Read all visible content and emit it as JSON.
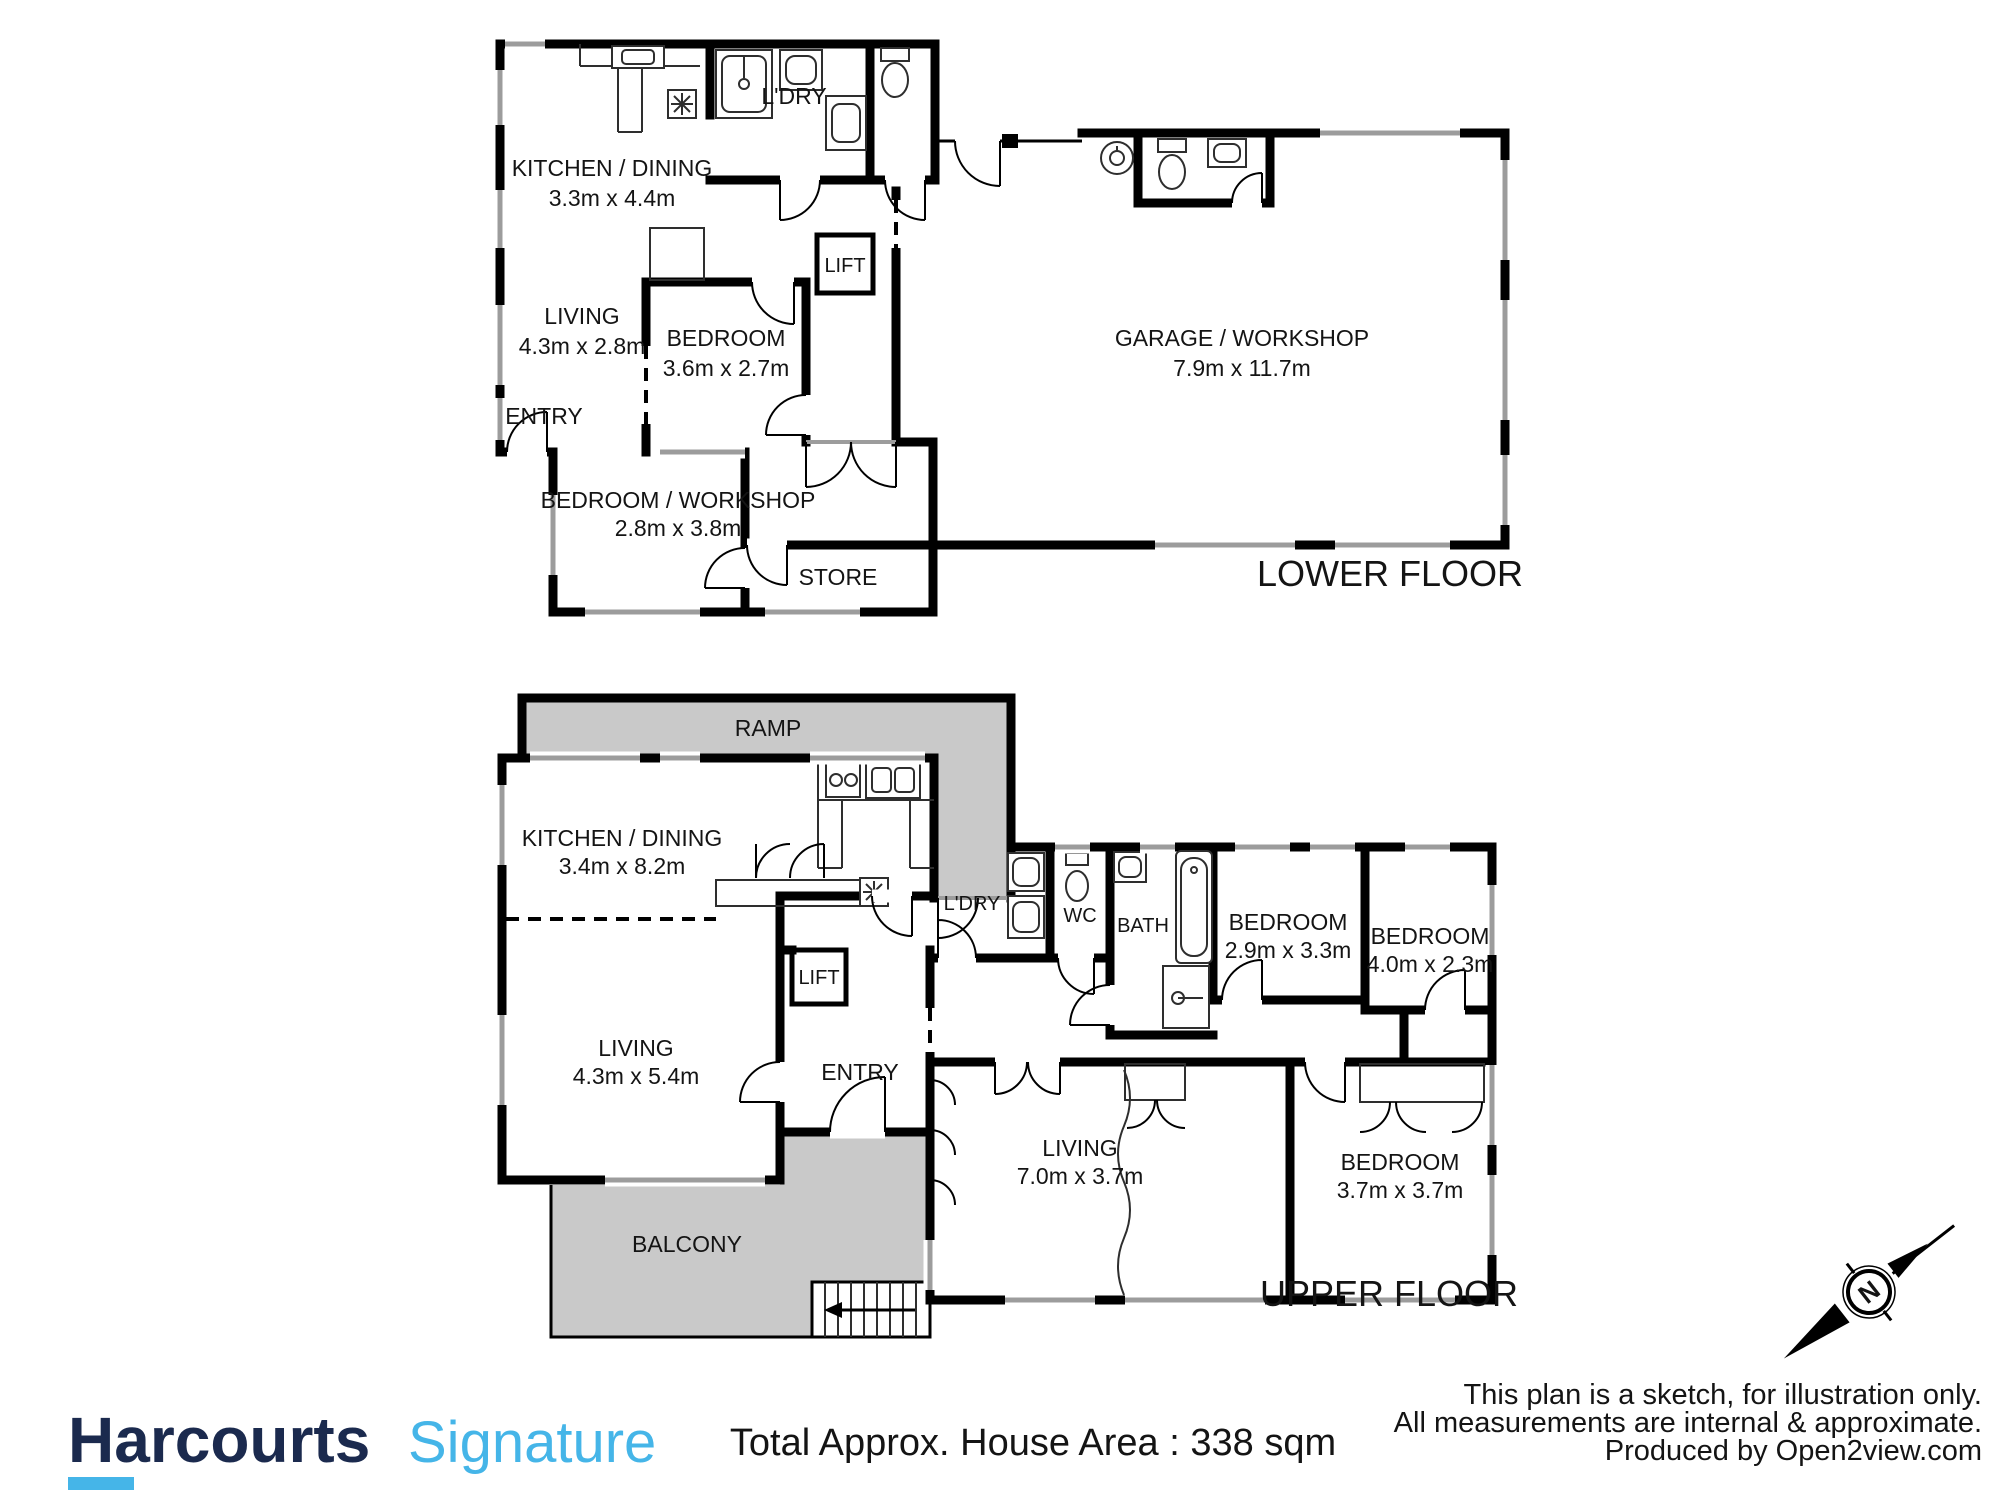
{
  "branding": {
    "brand": "Harcourts",
    "suffix": "Signature",
    "brand_color": "#1b2a4e",
    "accent_color": "#45b5e8"
  },
  "footer": {
    "area_text": "Total Approx. House Area : 338 sqm",
    "disclaimer": [
      "This plan is a sketch, for illustration only.",
      "All measurements are internal & approximate.",
      "Produced by Open2view.com"
    ]
  },
  "compass": {
    "north_label": "N"
  },
  "lower_floor": {
    "title": "LOWER FLOOR",
    "rooms": {
      "kitchen_dining": {
        "name": "KITCHEN / DINING",
        "dims": "3.3m x 4.4m"
      },
      "laundry": {
        "name": "L'DRY"
      },
      "living": {
        "name": "LIVING",
        "dims": "4.3m x 2.8m"
      },
      "bedroom": {
        "name": "BEDROOM",
        "dims": "3.6m x 2.7m"
      },
      "lift": {
        "name": "LIFT"
      },
      "entry": {
        "name": "ENTRY"
      },
      "bedroom_workshop": {
        "name": "BEDROOM / WORKSHOP",
        "dims": "2.8m x 3.8m"
      },
      "store": {
        "name": "STORE"
      },
      "garage": {
        "name": "GARAGE / WORKSHOP",
        "dims": "7.9m x 11.7m"
      }
    }
  },
  "upper_floor": {
    "title": "UPPER FLOOR",
    "rooms": {
      "ramp": {
        "name": "RAMP"
      },
      "kitchen_dining": {
        "name": "KITCHEN / DINING",
        "dims": "3.4m x 8.2m"
      },
      "laundry": {
        "name": "L'DRY"
      },
      "wc": {
        "name": "WC"
      },
      "bath": {
        "name": "BATH"
      },
      "bedroom1": {
        "name": "BEDROOM",
        "dims": "2.9m x 3.3m"
      },
      "bedroom2": {
        "name": "BEDROOM",
        "dims": "4.0m x 2.3m"
      },
      "living_main": {
        "name": "LIVING",
        "dims": "4.3m x 5.4m"
      },
      "lift": {
        "name": "LIFT"
      },
      "entry": {
        "name": "ENTRY"
      },
      "living2": {
        "name": "LIVING",
        "dims": "7.0m x 3.7m"
      },
      "bedroom3": {
        "name": "BEDROOM",
        "dims": "3.7m x 3.7m"
      },
      "balcony": {
        "name": "BALCONY"
      }
    }
  }
}
